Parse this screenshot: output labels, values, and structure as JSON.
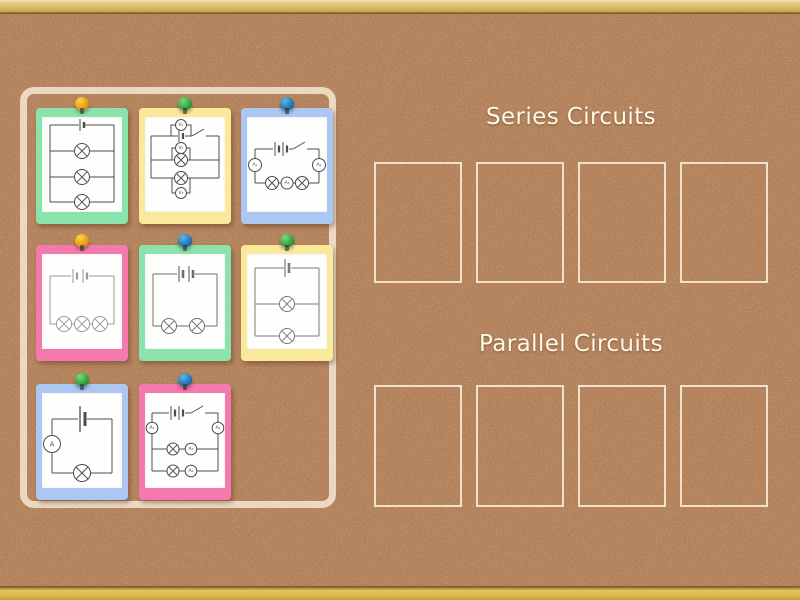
{
  "groups": [
    {
      "key": "series",
      "label": "Series Circuits",
      "slots": 4
    },
    {
      "key": "parallel",
      "label": "Parallel Circuits",
      "slots": 4
    }
  ],
  "cards": [
    {
      "name": "parallel-circuit-3-lamps",
      "color": "green",
      "pin": "orange"
    },
    {
      "name": "parallel-circuit-2-lamps-3-voltmeters-switch",
      "color": "yellow",
      "pin": "green",
      "meters": {
        "v1": "V₁",
        "v2": "V₂",
        "v3": "V₃"
      }
    },
    {
      "name": "series-circuit-2-lamps-3-ammeters-switch",
      "color": "blue",
      "pin": "blue",
      "meters": {
        "a1": "A₁",
        "a2": "A₂",
        "a3": "A₃"
      }
    },
    {
      "name": "series-circuit-3-lamps",
      "color": "pink",
      "pin": "orange"
    },
    {
      "name": "series-circuit-2-lamps",
      "color": "green",
      "pin": "blue"
    },
    {
      "name": "parallel-circuit-2-lamps",
      "color": "yellow",
      "pin": "green"
    },
    {
      "name": "series-circuit-1-lamp-1-ammeter",
      "color": "blue",
      "pin": "green",
      "meters": {
        "a": "A"
      }
    },
    {
      "name": "parallel-circuit-2-lamps-4-ammeters-switch",
      "color": "pink",
      "pin": "blue",
      "meters": {
        "a1": "A₁",
        "a2": "A₂",
        "a3": "A₃",
        "a4": "A₄"
      }
    }
  ],
  "palette": {
    "card_colors": {
      "green": "#8be3ac",
      "yellow": "#fbe99b",
      "blue": "#abc7f2",
      "pink": "#f479ad"
    },
    "pin_colors": {
      "orange": [
        "#ffd34e",
        "#e08a00"
      ],
      "green": [
        "#7ddc74",
        "#1e8f33"
      ],
      "blue": [
        "#5fb6e8",
        "#1463a8"
      ]
    },
    "cork_base": "#b2805a",
    "slot_border": "#f7ebd5",
    "title_color": "#fff8ec",
    "zone_border": "#f1e4ce"
  }
}
